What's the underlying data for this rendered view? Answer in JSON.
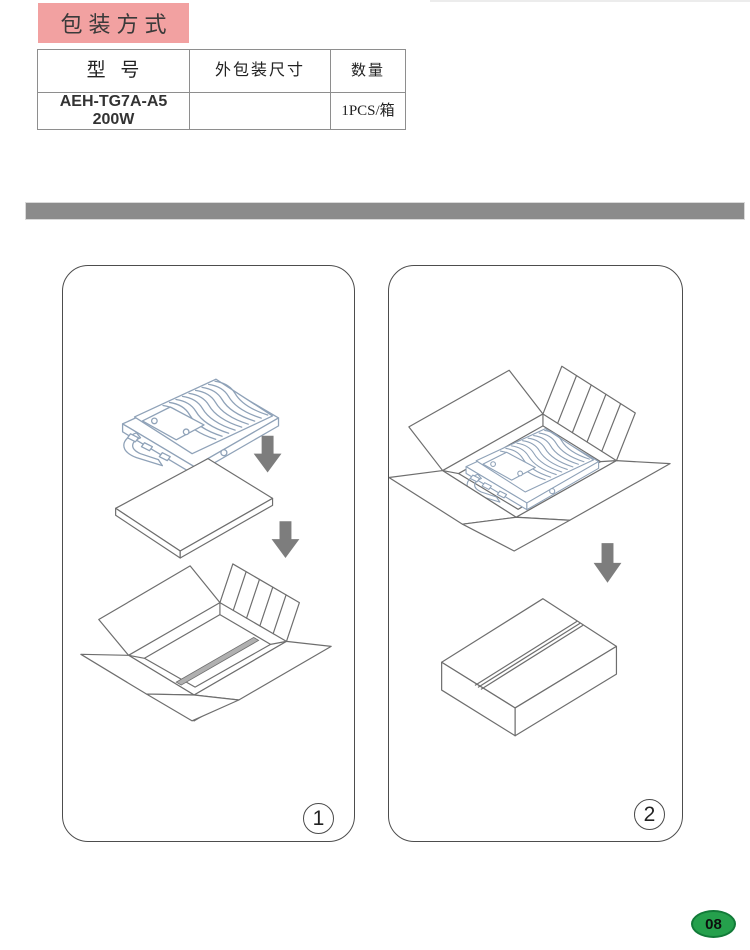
{
  "page": {
    "title": "包装方式",
    "page_number": "08"
  },
  "packing_table": {
    "headers": {
      "model": "型 号",
      "outer_size": "外包装尺寸",
      "quantity": "数量"
    },
    "row": {
      "model_line1": "AEH-TG7A-A5",
      "model_line2": "200W",
      "outer_size": "",
      "quantity": "1PCS/箱"
    }
  },
  "steps": [
    {
      "label": "1"
    },
    {
      "label": "2"
    }
  ],
  "colors": {
    "title_pink": "#f2a1a1",
    "divider_gray": "#8b8b8b",
    "badge_green": "#25a04c",
    "badge_border_green": "#127a38",
    "drawing_line_gray": "#6e6e6e",
    "floodlight_blue_gray": "#8fa2b8",
    "arrow_gray": "#7d7d7d"
  }
}
